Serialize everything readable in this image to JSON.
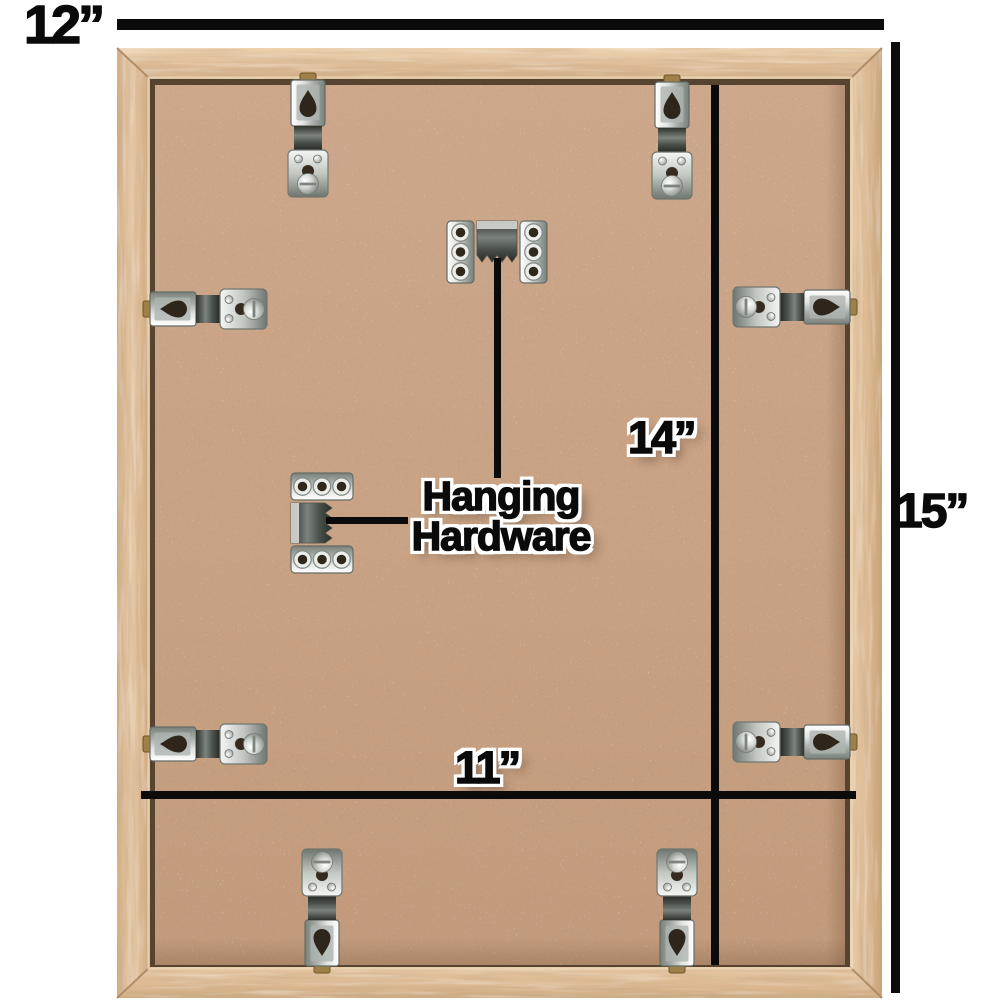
{
  "image": {
    "background_color": "#ffffff"
  },
  "frame": {
    "wood_color": "#dfc09e",
    "backing_color": "#c9a284",
    "metal_color": "#c7ccc8",
    "gap_shadow_color": "#5f4c36"
  },
  "annotations": {
    "line_color": "#0b0b0b",
    "outline_color": "#ffffff",
    "outer_width_label": "12”",
    "outer_height_label": "15”",
    "inner_height_label": "14”",
    "inner_width_label": "11”",
    "hardware_label_line1": "Hanging",
    "hardware_label_line2": "Hardware"
  }
}
